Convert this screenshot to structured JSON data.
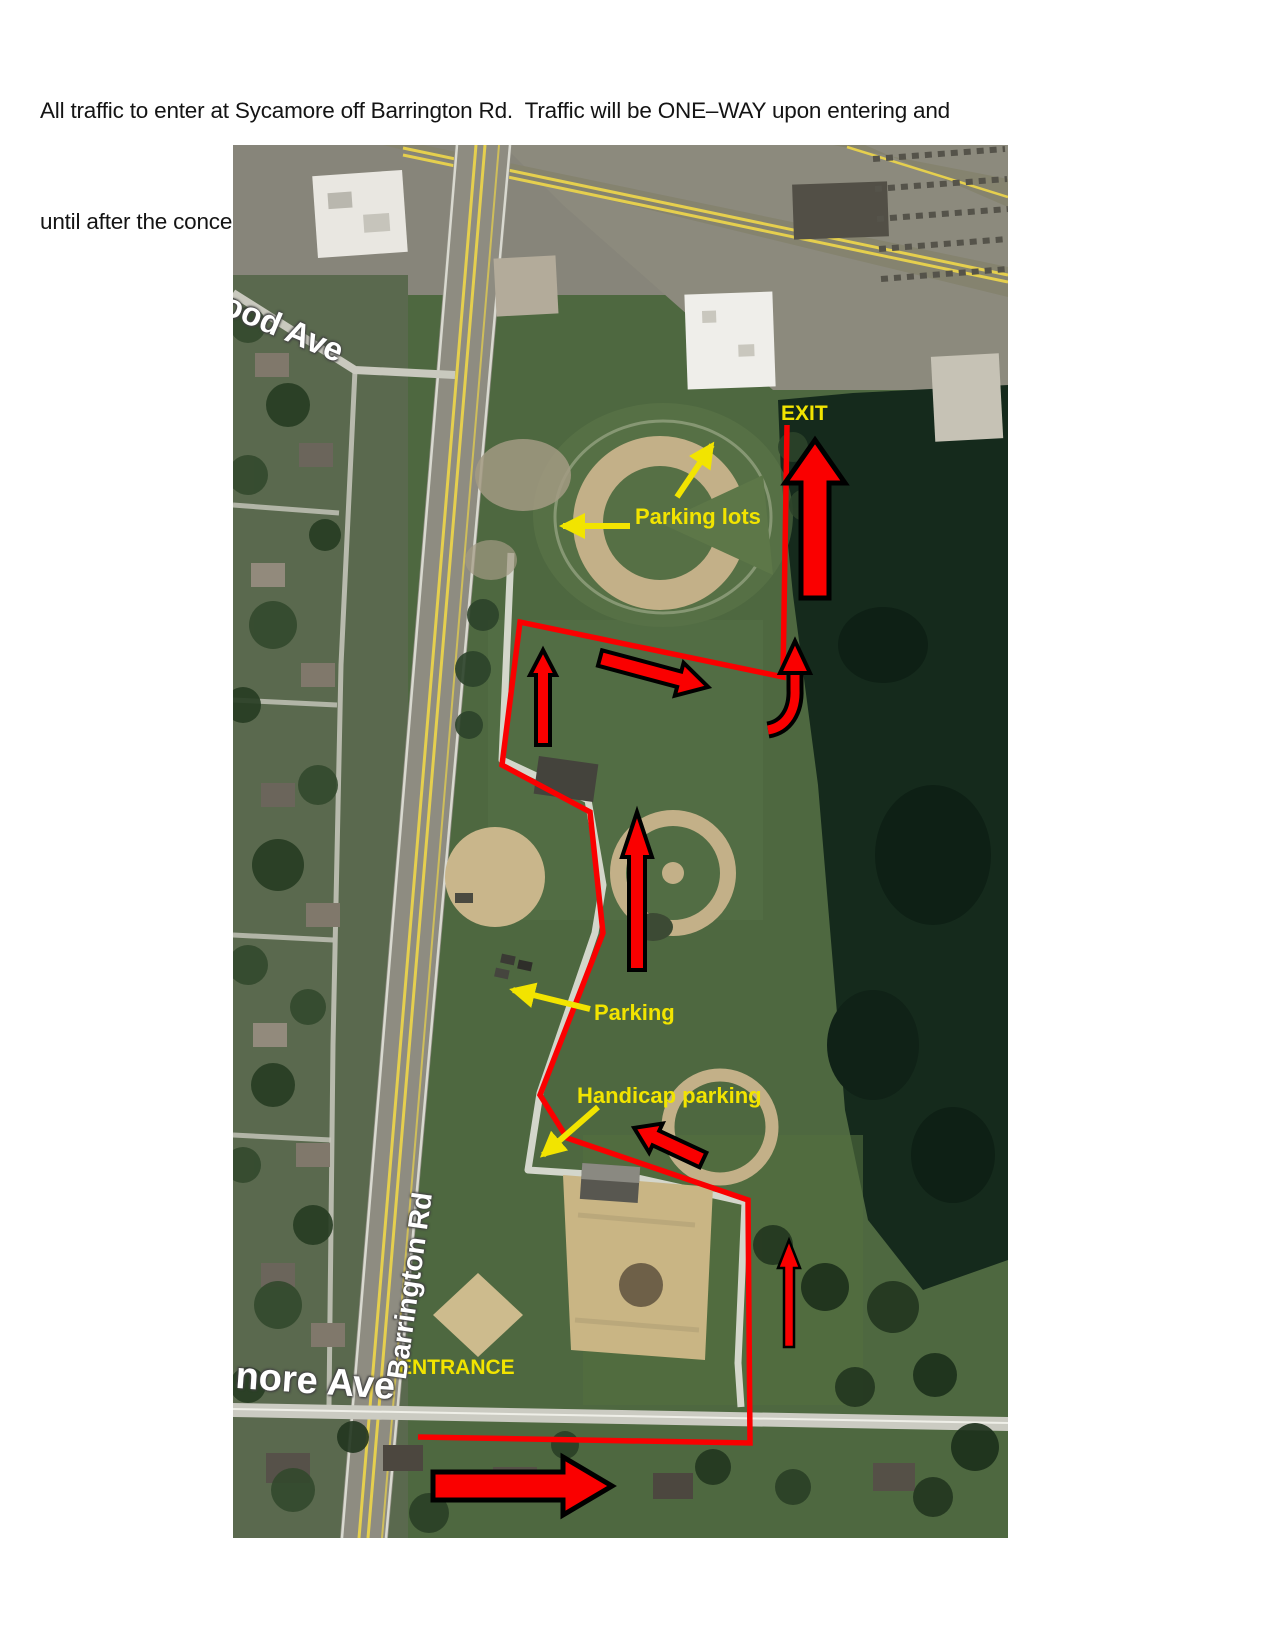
{
  "page": {
    "intro_line1": "All traffic to enter at Sycamore off Barrington Rd.  Traffic will be ONE–WAY upon entering and",
    "intro_line2": "until after the concert is over.  The only exit during the concert will be through the north end."
  },
  "map": {
    "annotation_labels": {
      "exit": "EXIT",
      "parking_lots": "Parking lots",
      "parking": "Parking",
      "handicap_parking": "Handicap parking",
      "entrance": "ENTRANCE"
    },
    "street_labels": {
      "barrington_rd": "Barrington Rd",
      "sycamore_ave_partial": "nore Ave",
      "wood_ave_partial": "ood Ave"
    },
    "colors": {
      "route_red": "#fa0000",
      "arrow_red": "#fa0000",
      "arrow_outline_black": "#000000",
      "annotation_yellow": "#f2e400",
      "street_label_white": "#ffffff"
    }
  }
}
